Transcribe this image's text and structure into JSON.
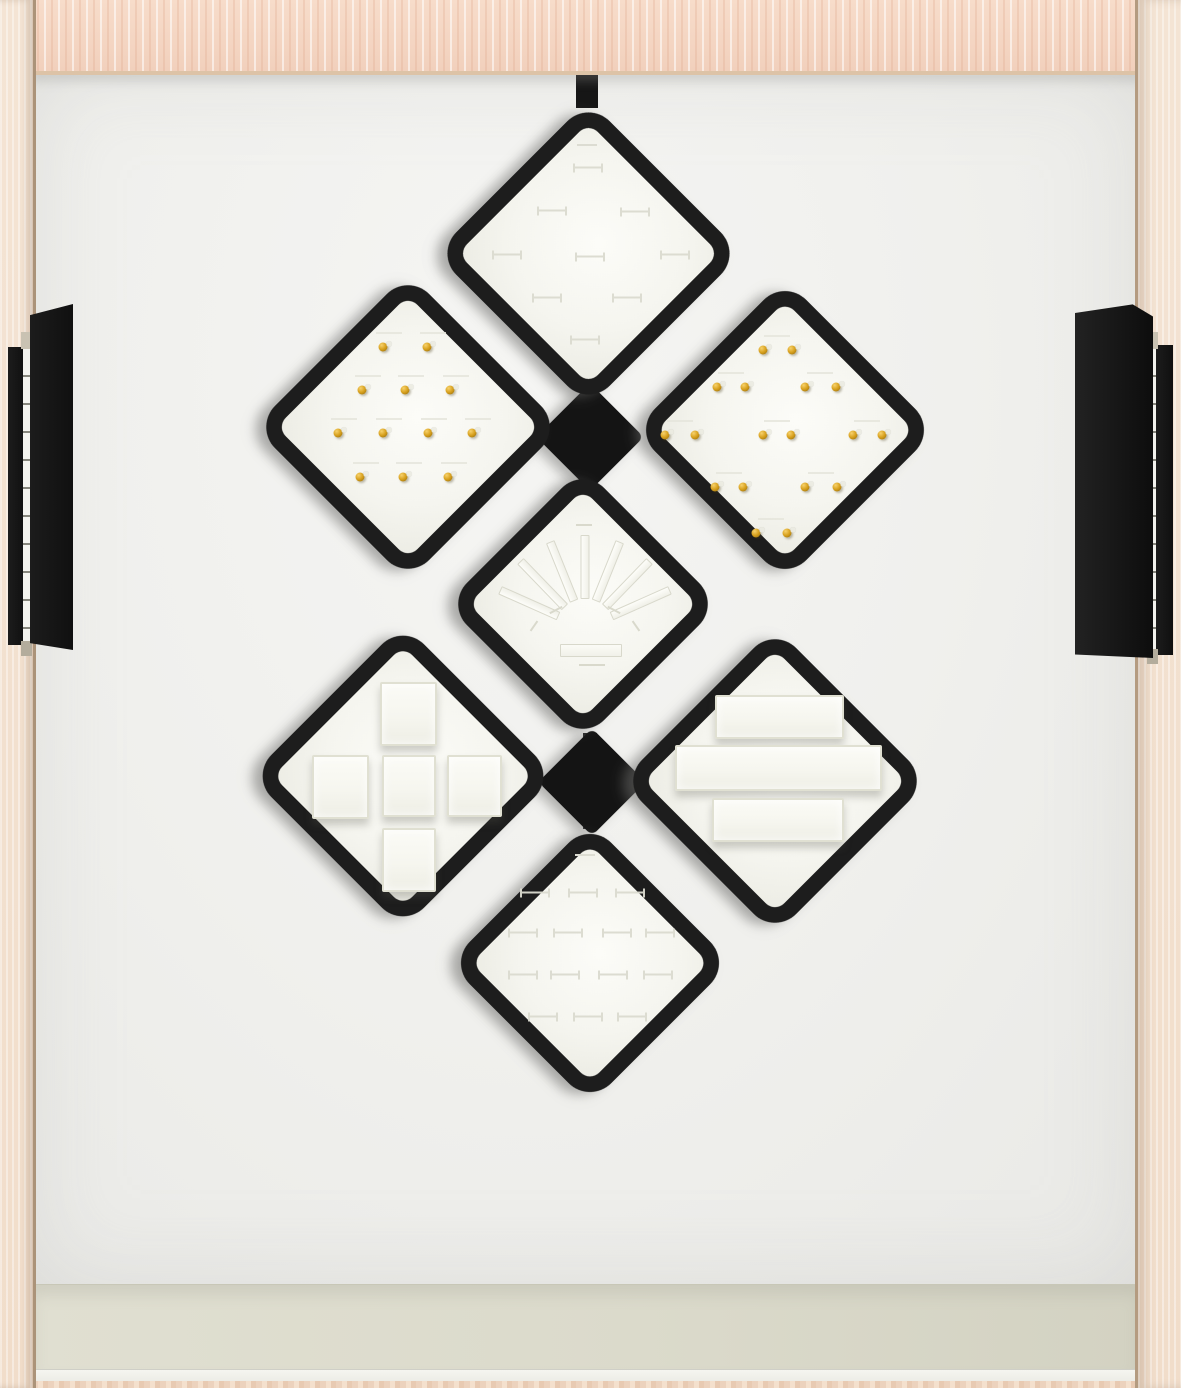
{
  "scene": {
    "description": "Empty jewelry display drawer: seven black diamond-shaped trays mounted between wood cabinet walls",
    "palette": {
      "top_wood": "#f4d5c2",
      "side_wall_wood": "#f3e2d2",
      "back_panel": "#f0f0ed",
      "floor_shelf": "#dbdacb",
      "tray_frame_black": "#1d1d1d",
      "tray_face_white": "#f6f6f0",
      "gold_stud": "#d8a11e",
      "slot_line": "#dbdbd0"
    }
  },
  "trays": [
    {
      "id": "top",
      "kind": "ring-slot-tray",
      "cx": 588,
      "cy": 253,
      "size": 217,
      "line_marks": [
        [
          587,
          145
        ]
      ],
      "slot_marks": [
        [
          588,
          168
        ],
        [
          552,
          211
        ],
        [
          635,
          212
        ],
        [
          507,
          255
        ],
        [
          590,
          257
        ],
        [
          675,
          255
        ],
        [
          547,
          298
        ],
        [
          627,
          298
        ],
        [
          585,
          340
        ]
      ]
    },
    {
      "id": "upper-left",
      "kind": "gold-stud-tray",
      "cx": 408,
      "cy": 427,
      "size": 218,
      "studs": [
        [
          383,
          347
        ],
        [
          427,
          347
        ],
        [
          362,
          390
        ],
        [
          405,
          390
        ],
        [
          450,
          390
        ],
        [
          338,
          433
        ],
        [
          383,
          433
        ],
        [
          428,
          433
        ],
        [
          472,
          433
        ],
        [
          360,
          477
        ],
        [
          403,
          477
        ],
        [
          448,
          477
        ]
      ],
      "dashes": [
        [
          389,
          333
        ],
        [
          433,
          333
        ],
        [
          368,
          376
        ],
        [
          411,
          376
        ],
        [
          456,
          376
        ],
        [
          344,
          419
        ],
        [
          389,
          419
        ],
        [
          434,
          419
        ],
        [
          478,
          419
        ],
        [
          366,
          463
        ],
        [
          409,
          463
        ],
        [
          454,
          463
        ]
      ]
    },
    {
      "id": "upper-right",
      "kind": "gold-stud-pair-tray",
      "cx": 785,
      "cy": 430,
      "size": 214,
      "studs": [
        [
          763,
          350
        ],
        [
          792,
          350
        ],
        [
          717,
          387
        ],
        [
          745,
          387
        ],
        [
          805,
          387
        ],
        [
          836,
          387
        ],
        [
          665,
          435
        ],
        [
          695,
          435
        ],
        [
          763,
          435
        ],
        [
          791,
          435
        ],
        [
          853,
          435
        ],
        [
          882,
          435
        ],
        [
          715,
          487
        ],
        [
          743,
          487
        ],
        [
          805,
          487
        ],
        [
          837,
          487
        ],
        [
          756,
          533
        ],
        [
          787,
          533
        ]
      ],
      "dashes": [
        [
          777,
          336
        ],
        [
          731,
          373
        ],
        [
          820,
          373
        ],
        [
          680,
          421
        ],
        [
          777,
          421
        ],
        [
          867,
          421
        ],
        [
          729,
          473
        ],
        [
          821,
          473
        ],
        [
          771,
          519
        ]
      ]
    },
    {
      "id": "middle",
      "kind": "bracelet-fan-tray",
      "cx": 583,
      "cy": 604,
      "size": 194,
      "fan": {
        "origin": [
          585,
          628
        ],
        "angles": [
          -66,
          -44,
          -22,
          0,
          22,
          44,
          66
        ],
        "radius": 61,
        "base_slot": [
          560,
          644,
          60,
          11
        ],
        "ticks": [
          [
            584,
            525,
            16,
            0
          ],
          [
            592,
            665,
            26,
            0
          ],
          [
            556,
            610,
            14,
            -28
          ],
          [
            614,
            610,
            14,
            28
          ],
          [
            534,
            626,
            12,
            -55
          ],
          [
            636,
            626,
            12,
            55
          ]
        ]
      }
    },
    {
      "id": "lower-left",
      "kind": "block-tray",
      "cx": 403,
      "cy": 776,
      "size": 216,
      "blocks": [
        [
          380,
          682,
          53,
          60
        ],
        [
          312,
          755,
          53,
          60
        ],
        [
          382,
          755,
          50,
          58
        ],
        [
          447,
          755,
          51,
          58
        ],
        [
          382,
          828,
          50,
          60
        ]
      ]
    },
    {
      "id": "lower-right",
      "kind": "bar-tray",
      "cx": 775,
      "cy": 781,
      "size": 218,
      "bars": [
        [
          715,
          695,
          125,
          40
        ],
        [
          675,
          745,
          203,
          42
        ],
        [
          712,
          798,
          128,
          40
        ]
      ]
    },
    {
      "id": "bottom",
      "kind": "ring-slot-tray",
      "cx": 590,
      "cy": 963,
      "size": 200,
      "line_marks": [
        [
          585,
          855
        ]
      ],
      "slot_marks": [
        [
          535,
          893
        ],
        [
          583,
          893
        ],
        [
          630,
          893
        ],
        [
          523,
          933
        ],
        [
          568,
          933
        ],
        [
          617,
          933
        ],
        [
          660,
          933
        ],
        [
          523,
          975
        ],
        [
          565,
          975
        ],
        [
          613,
          975
        ],
        [
          658,
          975
        ],
        [
          543,
          1017
        ],
        [
          588,
          1017
        ],
        [
          632,
          1017
        ]
      ]
    }
  ],
  "hardware": {
    "stems": [
      [
        576,
        58,
        22,
        50
      ],
      [
        581,
        392,
        14,
        86
      ],
      [
        583,
        733,
        14,
        96
      ]
    ],
    "connectors": [
      [
        590,
        437,
        76
      ],
      [
        592,
        782,
        76
      ]
    ],
    "hinges": {
      "left": {
        "outer_bar": [
          8,
          347,
          17,
          298
        ],
        "pin_strip": [
          23,
          349,
          7,
          292
        ],
        "main_bar": [
          30,
          304,
          43,
          346
        ]
      },
      "right": {
        "outer_bar": [
          1156,
          345,
          17,
          310
        ],
        "pin_strip": [
          1149,
          349,
          7,
          300
        ],
        "main_bar": [
          1075,
          303,
          78,
          355
        ]
      }
    }
  }
}
